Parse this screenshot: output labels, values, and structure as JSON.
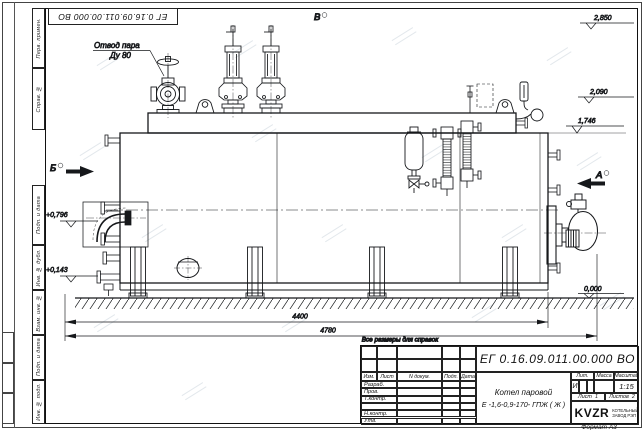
{
  "page": {
    "format_label": "Формат А3"
  },
  "border_frame": {
    "doc_number_inverted": "ЕГ 0.16.09.011.00.000  ВО",
    "stamps": [
      "Перв. примен.",
      "Справ. №",
      "Подп. и дата",
      "Инв. № дубл.",
      "Взам. инв. №",
      "Подп. и дата",
      "Инв. № подл."
    ]
  },
  "drawing": {
    "callout_steam": {
      "line1": "Отвод пара",
      "line2": "Ду 80"
    },
    "views": {
      "b": "Б",
      "v": "В",
      "a": "А"
    },
    "elevations": {
      "e2850": "2,850",
      "e2090": "2,090",
      "e1746": "1,746",
      "e0": "0,000",
      "e0796": "+0,796",
      "e0143": "+0,143"
    },
    "dims": {
      "d4400": "4400",
      "d4780": "4780"
    },
    "note": "Все размеры для справок"
  },
  "title_block": {
    "doc_number": "ЕГ 0.16.09.011.00.000  ВО",
    "name_line1": "Котел паровой",
    "name_line2": "Е -1,6-0,9-170- ГПЖ ( Ж )",
    "cols": {
      "izm": "Изм.",
      "list": "Лист",
      "ndoc": "N докум.",
      "podp": "Подп.",
      "date": "Дата"
    },
    "rows": [
      "Разраб.",
      "Пров.",
      "Т.контр.",
      "",
      "Н.контр.",
      "Утв."
    ],
    "lit": {
      "header": "Лит.",
      "value": "И"
    },
    "mass": {
      "header": "Масса",
      "value": ""
    },
    "scale": {
      "header": "Масштаб",
      "value": "1:15"
    },
    "sheet": {
      "label": "Лист",
      "value": "1"
    },
    "sheets": {
      "label": "Листов",
      "value": "2"
    },
    "logo": {
      "text": "KVZR",
      "sub1": "КОТЕЛЬНЫЙ",
      "sub2": "ЗАВОД РЭП"
    }
  }
}
